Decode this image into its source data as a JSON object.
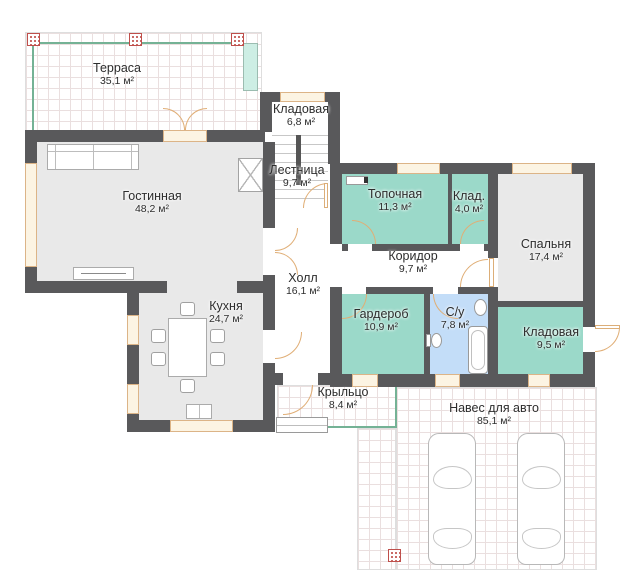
{
  "plan": {
    "title": "План 1-го этажа",
    "rooms": [
      {
        "id": "terrace",
        "name": "Терраса",
        "area": "35,1 м²"
      },
      {
        "id": "living-room",
        "name": "Гостинная",
        "area": "48,2 м²"
      },
      {
        "id": "storage-top",
        "name": "Кладовая",
        "area": "6,8 м²"
      },
      {
        "id": "stairs",
        "name": "Лестница",
        "area": "9,7 м²"
      },
      {
        "id": "hall",
        "name": "Холл",
        "area": "16,1 м²"
      },
      {
        "id": "kitchen",
        "name": "Кухня",
        "area": "24,7 м²"
      },
      {
        "id": "boiler-room",
        "name": "Топочная",
        "area": "11,3 м²"
      },
      {
        "id": "closet",
        "name": "Клад.",
        "area": "4,0 м²"
      },
      {
        "id": "bedroom",
        "name": "Спальня",
        "area": "17,4 м²"
      },
      {
        "id": "corridor",
        "name": "Коридор",
        "area": "9,7 м²"
      },
      {
        "id": "wardrobe",
        "name": "Гардероб",
        "area": "10,9 м²"
      },
      {
        "id": "bathroom",
        "name": "С/у",
        "area": "7,8 м²"
      },
      {
        "id": "storage-right",
        "name": "Кладовая",
        "area": "9,5 м²"
      },
      {
        "id": "porch",
        "name": "Крыльцо",
        "area": "8,4 м²"
      },
      {
        "id": "carport",
        "name": "Навес для авто",
        "area": "85,1 м²"
      }
    ],
    "colors": {
      "wall": "#59595b",
      "room_gray": "#e9e9e9",
      "room_teal": "#9bd9c9",
      "room_blue": "#c3ddf8",
      "door_arc": "#e0ae76",
      "window_fill": "#fcf4e3",
      "terrace_green": "#74b295",
      "column_marker": "#bf4f4b",
      "grid_line": "#eadfdf"
    }
  }
}
